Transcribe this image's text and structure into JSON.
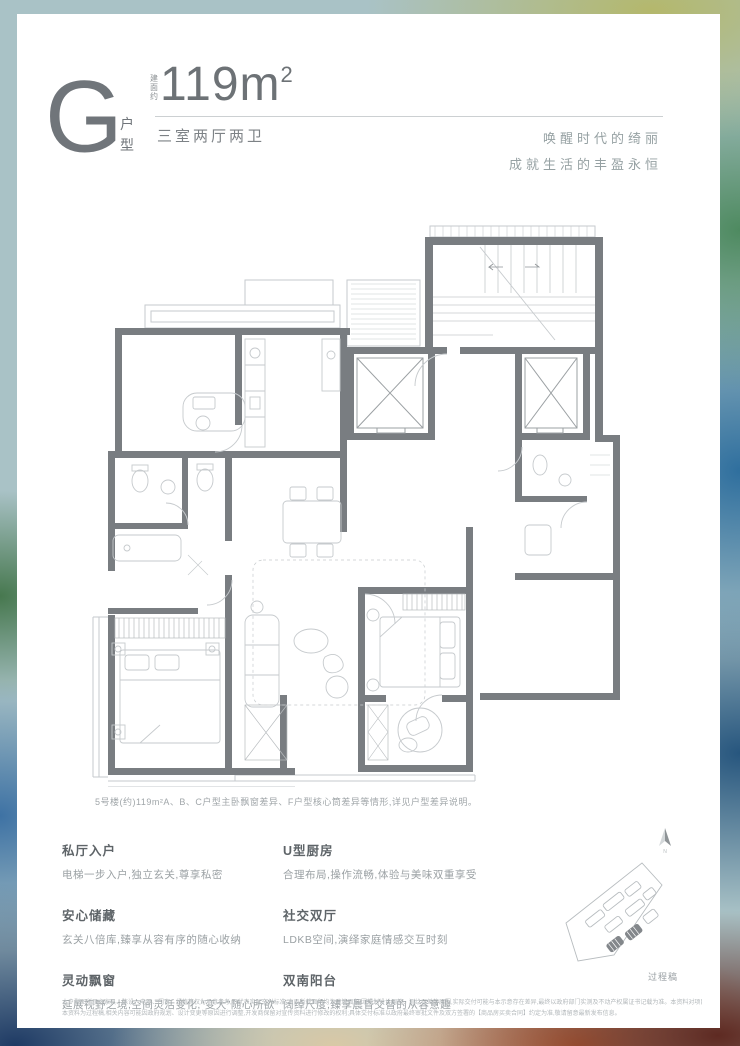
{
  "header": {
    "type_letter": "G",
    "type_suffix": "户型",
    "area_label": "建面约",
    "area_number": "119m",
    "area_exponent": "2",
    "rooms": "三室两厅两卫",
    "slogans": [
      "唤醒时代的绮丽",
      "成就生活的丰盈永恒"
    ]
  },
  "plan": {
    "note": "5号楼(约)119m²A、B、C户型主卧飘窗差异、F户型核心筒差异等情形,详见户型差异说明。",
    "compass_icon": "north-arrow",
    "site_diagram": "site-plan-with-highlighted-buildings"
  },
  "features": {
    "left": [
      {
        "title": "私厅入户",
        "desc": "电梯一步入户,独立玄关,尊享私密"
      },
      {
        "title": "安心储藏",
        "desc": "玄关八倍库,臻享从容有序的随心收纳"
      },
      {
        "title": "灵动飘窗",
        "desc": "延展视野之境,空间灵活变化,“变大”随心所欲"
      }
    ],
    "right": [
      {
        "title": "U型厨房",
        "desc": "合理布局,操作流畅,体验与美味双重享受"
      },
      {
        "title": "社交双厅",
        "desc": "LDKB空间,演绎家庭情感交互时刻"
      },
      {
        "title": "双南阳台",
        "desc": "阔绰尺度,臻享晨昏交替的从容意趣"
      }
    ]
  },
  "footer": {
    "draft_label": "过程稿",
    "disclaimer_lines": [
      "本户型图所示之家具、陈设、电器、门窗、绿植等仅为示意参考,不代表实际交付标准;本页所载面积均为建筑面积,因规划设计调整、测绘误差等原因,实际交付可能与本示意存在差异,最终以政府部门实测及不动产权属证书记载为准。本资料对项目周边环境、交通、教育、商业等配套设施的介绍旨在提供相关信息,不构成要约或承诺,具体以商品房买卖合同及其附件约定为准。",
      "本资料为过程稿,相关内容可能因政府规划、设计变更等原因进行调整,开发商保留对宣传资料进行修改的权利;具体交付标准以政府最终审批文件及双方签署的【商品房买卖合同】约定为准,敬请留意最新发布信息。"
    ]
  },
  "colors": {
    "card_bg": "#ffffff",
    "text_primary": "#6d7276",
    "text_secondary": "#9ba1a4",
    "wall": "#797d81",
    "plan_line": "#c6cacd",
    "bg_teal": "#a9c2c6",
    "bg_green": "#47784f",
    "bg_blue": "#2f6f9e",
    "bg_navy": "#1e3a64",
    "bg_orange": "#c4693c",
    "bg_olive": "#b4b86c"
  }
}
